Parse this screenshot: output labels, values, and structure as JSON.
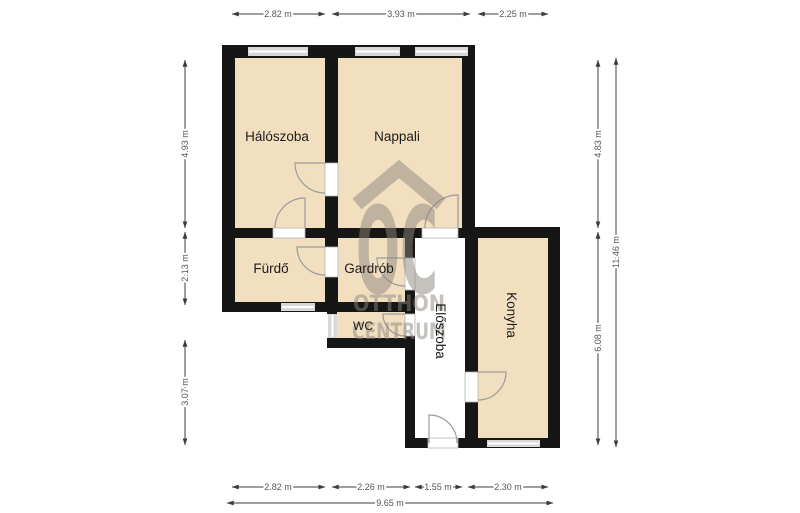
{
  "plan": {
    "rooms": [
      {
        "id": "haloszoba",
        "label": "Hálószoba"
      },
      {
        "id": "nappali",
        "label": "Nappali"
      },
      {
        "id": "furdo",
        "label": "Fürdő"
      },
      {
        "id": "gardrob",
        "label": "Gardrób"
      },
      {
        "id": "wc",
        "label": "WC"
      },
      {
        "id": "eloszoba",
        "label": "Előszoba"
      },
      {
        "id": "konyha",
        "label": "Konyha"
      }
    ],
    "dimensions": {
      "top": [
        "2.82 m",
        "3.93 m",
        "2.25 m"
      ],
      "bottom": [
        "2.82 m",
        "2.26 m",
        "1.55 m",
        "2.30 m"
      ],
      "bottom_total": "9.65 m",
      "left": [
        "4.93 m",
        "2.13 m",
        "3.07 m"
      ],
      "right_inner": [
        "4.83 m",
        "6.08 m"
      ],
      "right_total": "11.46 m"
    },
    "watermark": {
      "monogram": "OC",
      "line1": "OTTHON",
      "line2": "CENTRUM"
    },
    "colors": {
      "room_fill": "#f2dfc0",
      "wall": "#161616",
      "window": "#d7d7d7",
      "watermark": "#8d867f",
      "dimension": "#3c3c3c"
    }
  }
}
